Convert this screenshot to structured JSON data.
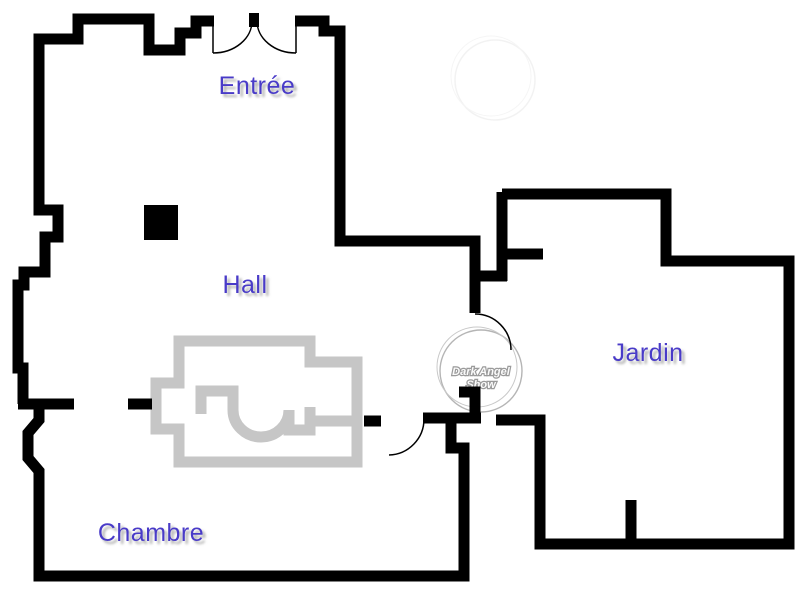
{
  "floorplan": {
    "title": "Apartment floor plan",
    "rooms": [
      {
        "id": "entree",
        "label": "Entrée"
      },
      {
        "id": "hall",
        "label": "Hall"
      },
      {
        "id": "jardin",
        "label": "Jardin"
      },
      {
        "id": "chambre",
        "label": "Chambre"
      }
    ],
    "watermark": {
      "line1": "Dark Angel",
      "line2": "Show"
    },
    "colors": {
      "wall": "#000000",
      "furniture": "#c6c6c6",
      "label": "#4a3ac8",
      "label_shadow": "#9a9a9a",
      "watermark_ring": "#b5b5b5",
      "watermark_text": "#fafafa",
      "watermark_text_outline": "#9a9a9a",
      "background": "#ffffff"
    }
  }
}
